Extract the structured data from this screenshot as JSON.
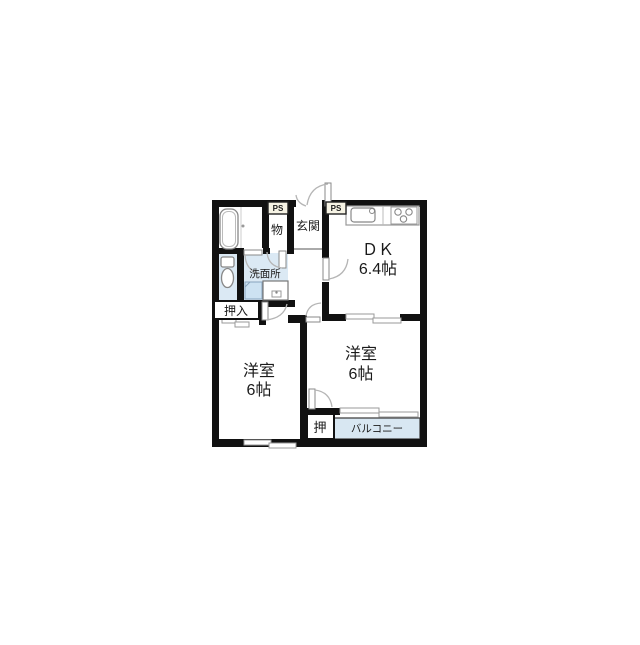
{
  "floorplan": {
    "type": "apartment-floor-plan",
    "rooms": {
      "dk": {
        "name": "ＤＫ",
        "size": "6.4帖"
      },
      "bedroom_left": {
        "name": "洋室",
        "size": "6帖"
      },
      "bedroom_right": {
        "name": "洋室",
        "size": "6帖"
      },
      "entrance": {
        "name": "玄関"
      },
      "storage": {
        "name": "物"
      },
      "washroom": {
        "name": "洗面所"
      },
      "closet_oshiire": {
        "name": "押入"
      },
      "closet_oshi": {
        "name": "押"
      },
      "balcony": {
        "name": "バルコニー"
      },
      "ps_left": {
        "name": "PS"
      },
      "ps_right": {
        "name": "PS"
      }
    },
    "colors": {
      "wall": "#111111",
      "water_floor": "#dbe9f4",
      "pan_floor": "#cde2f2",
      "balcony_floor": "#d8e7f2",
      "ps_fill": "#f6f3e4",
      "arc": "#b5b5b5"
    }
  }
}
